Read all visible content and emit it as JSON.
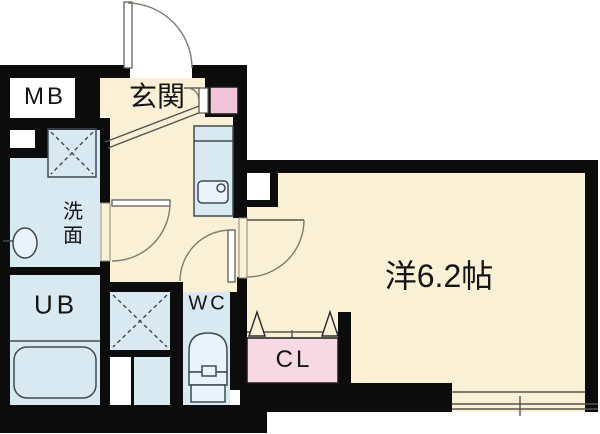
{
  "title": "apartment-floor-plan",
  "labels": {
    "meter_box": "MB",
    "entrance": "玄関",
    "washroom": "洗面",
    "unit_bath": "UB",
    "toilet": "WC",
    "closet": "CL",
    "main_room": "洋6.2帖"
  },
  "colors": {
    "wall": "#0c0c0c",
    "floor_cream": "#faf0d6",
    "wet_area_blue": "#d9e9f2",
    "closet_pink": "#f7d9e4",
    "shoebox_pink": "#f1c4d9",
    "fixture_line": "#3d4a52",
    "door_arc": "#7d7d6f"
  }
}
